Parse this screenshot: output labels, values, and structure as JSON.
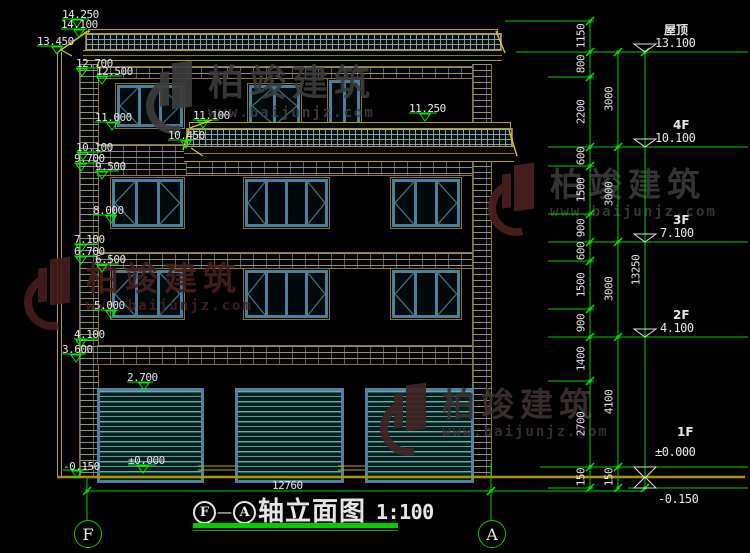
{
  "drawing_title": {
    "axis_from": "F",
    "dash": "—",
    "axis_to": "A",
    "name": "轴立面图",
    "scale": "1:100"
  },
  "bottom_dimension": "12760",
  "axis_bubbles": {
    "left": "F",
    "right": "A"
  },
  "colors": {
    "dim_green": "#00cc00",
    "bright_green": "#00ee00",
    "cad_yellow": "#b8a818",
    "leader_yellow": "#d8c820",
    "white": "#e6e6e6",
    "frame_blue": "#4e7d99",
    "glass_teal": "#3c7585",
    "ground_yellow": "#a89410"
  },
  "left_markers": [
    {
      "label": "14.250",
      "x": 62,
      "y": 9,
      "ul": [
        62,
        19,
        27
      ],
      "tri": [
        72,
        20
      ]
    },
    {
      "label": "14.100",
      "x": 61,
      "y": 19,
      "ul": [
        61,
        29,
        26
      ],
      "tri": [
        74,
        30
      ],
      "leader": [
        84,
        33,
        90,
        31
      ]
    },
    {
      "label": "13.450",
      "x": 37,
      "y": 36,
      "ul": [
        37,
        46,
        26
      ],
      "tri": [
        52,
        47
      ],
      "leader": [
        61,
        50,
        72,
        56
      ]
    },
    {
      "label": "12.700",
      "x": 76,
      "y": 58,
      "ul": [
        76,
        68,
        26
      ],
      "tri": [
        77,
        69
      ]
    },
    {
      "label": "12.500",
      "x": 96,
      "y": 66,
      "ul": [
        96,
        76,
        26
      ],
      "tri": [
        97,
        77
      ]
    },
    {
      "label": "11.100",
      "x": 193,
      "y": 110,
      "ul": [
        193,
        120,
        26
      ],
      "tri": [
        198,
        121
      ],
      "leader": [
        212,
        120,
        190,
        128
      ]
    },
    {
      "label": "11.250",
      "x": 409,
      "y": 103,
      "ul": [
        409,
        113,
        28
      ],
      "tri": [
        420,
        114
      ]
    },
    {
      "label": "11.000",
      "x": 95,
      "y": 112,
      "ul": [
        95,
        122,
        26
      ],
      "tri": [
        107,
        123
      ]
    },
    {
      "label": "10.450",
      "x": 168,
      "y": 130,
      "ul": [
        168,
        140,
        26
      ],
      "tri": [
        181,
        141
      ],
      "leader": [
        191,
        148,
        203,
        156
      ]
    },
    {
      "label": "10.100",
      "x": 76,
      "y": 142,
      "ul": [
        76,
        152,
        26
      ],
      "tri": [
        78,
        153
      ]
    },
    {
      "label": "9.700",
      "x": 74,
      "y": 153,
      "ul": [
        74,
        163,
        24
      ],
      "tri": [
        76,
        164
      ]
    },
    {
      "label": "9.500",
      "x": 95,
      "y": 161,
      "ul": [
        95,
        171,
        24
      ],
      "tri": [
        97,
        172
      ]
    },
    {
      "label": "8.000",
      "x": 93,
      "y": 205,
      "ul": [
        93,
        215,
        24
      ],
      "tri": [
        106,
        216
      ]
    },
    {
      "label": "7.100",
      "x": 74,
      "y": 234,
      "ul": [
        74,
        244,
        24
      ],
      "tri": [
        76,
        245
      ]
    },
    {
      "label": "6.700",
      "x": 74,
      "y": 246,
      "ul": [
        74,
        256,
        24
      ],
      "tri": [
        76,
        257
      ]
    },
    {
      "label": "6.500",
      "x": 95,
      "y": 254,
      "ul": [
        95,
        264,
        24
      ],
      "tri": [
        97,
        265
      ]
    },
    {
      "label": "5.000",
      "x": 94,
      "y": 300,
      "ul": [
        94,
        310,
        24
      ],
      "tri": [
        106,
        311
      ]
    },
    {
      "label": "4.100",
      "x": 74,
      "y": 329,
      "ul": [
        74,
        339,
        24
      ],
      "tri": [
        76,
        340
      ]
    },
    {
      "label": "3.600",
      "x": 62,
      "y": 344,
      "ul": [
        62,
        354,
        24
      ],
      "tri": [
        71,
        355
      ]
    },
    {
      "label": "2.700",
      "x": 127,
      "y": 372,
      "ul": [
        127,
        382,
        26
      ],
      "tri": [
        139,
        383
      ]
    },
    {
      "label": "±0.000",
      "x": 128,
      "y": 455,
      "ul": [
        128,
        465,
        28
      ],
      "tri": [
        138,
        466
      ]
    },
    {
      "label": "-0.150",
      "x": 63,
      "y": 461,
      "ul": [
        63,
        470,
        26
      ],
      "tri": [
        72,
        471
      ]
    }
  ],
  "right_levels": [
    {
      "floor": "屋顶",
      "elev": "13.100",
      "y": 52,
      "fx": 664,
      "fy": 24,
      "ex": 655,
      "ey": 37
    },
    {
      "floor": "4F",
      "elev": "10.100",
      "y": 147,
      "fx": 673,
      "fy": 119,
      "ex": 655,
      "ey": 132
    },
    {
      "floor": "3F",
      "elev": "7.100",
      "y": 242,
      "fx": 673,
      "fy": 214,
      "ex": 660,
      "ey": 227
    },
    {
      "floor": "2F",
      "elev": "4.100",
      "y": 337,
      "fx": 673,
      "fy": 309,
      "ex": 660,
      "ey": 322
    },
    {
      "floor": "1F",
      "elev": "±0.000",
      "y": 467,
      "fx": 677,
      "fy": 426,
      "ex": 655,
      "ey": 446
    },
    {
      "floor": "",
      "elev": "-0.150",
      "y": 488,
      "fx": 0,
      "fy": 0,
      "ex": 658,
      "ey": 493
    }
  ],
  "dim_chains": [
    {
      "x": 590,
      "ticks": [
        21,
        52,
        77,
        147,
        166,
        214,
        242,
        261,
        309,
        337,
        381,
        467,
        488
      ],
      "labels": [
        [
          "1150",
          36
        ],
        [
          "800",
          64
        ],
        [
          "2200",
          112
        ],
        [
          "600",
          156
        ],
        [
          "1500",
          190
        ],
        [
          "900",
          228
        ],
        [
          "600",
          251
        ],
        [
          "1500",
          285
        ],
        [
          "900",
          323
        ],
        [
          "1400",
          359
        ],
        [
          "2700",
          424
        ],
        [
          "150",
          477
        ]
      ]
    },
    {
      "x": 618,
      "ticks": [
        52,
        147,
        242,
        337,
        467,
        488
      ],
      "labels": [
        [
          "3000",
          99
        ],
        [
          "3000",
          194
        ],
        [
          "3000",
          289
        ],
        [
          "4100",
          402
        ],
        [
          "150",
          477
        ]
      ]
    },
    {
      "x": 645,
      "ticks": [
        52,
        488
      ],
      "labels": [
        [
          "13250",
          270
        ]
      ]
    }
  ],
  "watermarks": [
    {
      "x": 146,
      "y": 62,
      "logo_color": "#3c3c3c",
      "text_color": "#3c3c3c",
      "size": 36,
      "text": "柏竣建筑",
      "url": "www.baijunjz.com"
    },
    {
      "x": 488,
      "y": 164,
      "logo_color": "#4a2020",
      "text_color": "#3a3a3a",
      "size": 33,
      "text": "柏竣建筑",
      "url": "www.baijunjz.com"
    },
    {
      "x": 24,
      "y": 258,
      "logo_color": "#441d1d",
      "text_color": "#471f1f",
      "size": 33,
      "text": "柏竣建筑",
      "url": "www.baijunjz.com"
    },
    {
      "x": 380,
      "y": 384,
      "logo_color": "#402424",
      "text_color": "#3d3030",
      "size": 33,
      "text": "柏竣建筑",
      "url": "www.baijunjz.com"
    }
  ],
  "structure": {
    "main_roof": {
      "ridge": [
        88,
        29,
        408,
        5
      ],
      "hatch": [
        85,
        33,
        415,
        18
      ],
      "fascia": [
        83,
        50,
        419,
        9
      ]
    },
    "canopy_roof": {
      "ridge": [
        189,
        122,
        320,
        6
      ],
      "hatch": [
        186,
        128,
        325,
        18
      ],
      "fascia": [
        184,
        146,
        330,
        14
      ]
    },
    "roof_diagonals": [
      [
        88,
        31,
        58,
        52
      ],
      [
        496,
        31,
        505,
        53
      ],
      [
        189,
        130,
        183,
        150
      ],
      [
        509,
        130,
        517,
        156
      ]
    ],
    "left_outline_x": [
      57,
      61
    ],
    "outline_y": [
      52,
      477
    ],
    "piers": [
      [
        79,
        64,
        18,
        413
      ],
      [
        472,
        64,
        18,
        413
      ]
    ],
    "bands": [
      [
        97,
        66,
        375,
        11
      ],
      [
        97,
        144,
        89,
        30
      ],
      [
        186,
        160,
        286,
        14
      ],
      [
        97,
        252,
        375,
        15
      ],
      [
        97,
        345,
        375,
        18
      ]
    ],
    "windows": [
      {
        "x": 115,
        "y": 83,
        "w": 68,
        "h": 44,
        "panes": [
          "lt",
          "",
          "rt"
        ]
      },
      {
        "x": 247,
        "y": 83,
        "w": 53,
        "h": 44,
        "panes": [
          "lt",
          "rt"
        ]
      },
      {
        "x": 327,
        "y": 78,
        "w": 33,
        "h": 49,
        "panes": [
          "",
          ""
        ],
        "door": true
      },
      {
        "x": 110,
        "y": 177,
        "w": 73,
        "h": 50,
        "panes": [
          "lt",
          "",
          "rt"
        ]
      },
      {
        "x": 243,
        "y": 177,
        "w": 85,
        "h": 50,
        "panes": [
          "lt",
          "",
          "",
          "rt"
        ]
      },
      {
        "x": 390,
        "y": 177,
        "w": 70,
        "h": 50,
        "panes": [
          "lt",
          "",
          "rt"
        ]
      },
      {
        "x": 110,
        "y": 268,
        "w": 73,
        "h": 50,
        "panes": [
          "lt",
          "",
          "rt"
        ]
      },
      {
        "x": 243,
        "y": 268,
        "w": 85,
        "h": 50,
        "panes": [
          "lt",
          "",
          "",
          "rt"
        ]
      },
      {
        "x": 390,
        "y": 268,
        "w": 70,
        "h": 50,
        "panes": [
          "lt",
          "",
          "rt"
        ]
      }
    ],
    "garage_doors": [
      [
        97,
        388,
        101,
        89
      ],
      [
        235,
        388,
        103,
        89
      ],
      [
        365,
        388,
        103,
        89
      ]
    ],
    "thresholds": [
      [
        198,
        37
      ],
      [
        338,
        27
      ]
    ],
    "ground": {
      "y": 477,
      "x1": 57,
      "x2": 745
    },
    "bottom_dim": {
      "y": 491,
      "x1": 87,
      "x2": 645,
      "axis_a_x": 491,
      "label_x": 272,
      "label_y": 480
    },
    "axis_circles": [
      {
        "cx": 87,
        "cy": 533,
        "r": 13
      },
      {
        "cx": 491,
        "cy": 533,
        "r": 13
      }
    ]
  },
  "title_block": {
    "x": 193,
    "y": 500,
    "underline": [
      193,
      523,
      205,
      5
    ],
    "underline2": [
      193,
      530,
      205,
      1
    ]
  }
}
